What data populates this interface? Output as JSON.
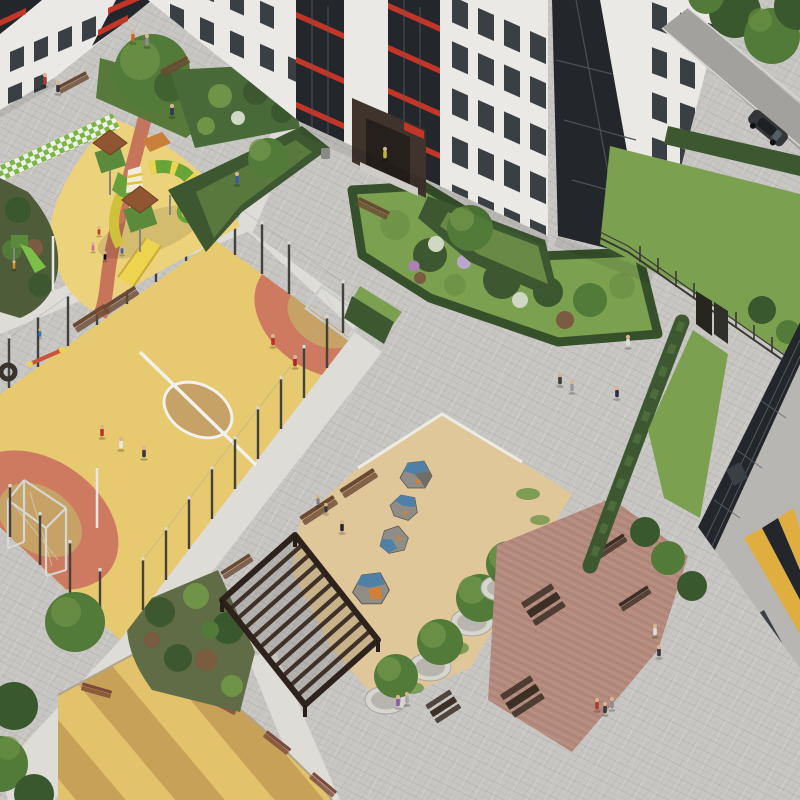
{
  "scene": {
    "title": "Aerial 3D rendering of a residential courtyard",
    "type": "architectural-visualization",
    "view": "isometric aerial view",
    "setting": "apartment complex courtyard with sports field, playgrounds, pergola and landscaping"
  },
  "palette": {
    "plaza": "#c9c7c3",
    "pathLight": "#dedcd6",
    "fieldYellow": "#e7c96f",
    "fieldTan": "#c7a267",
    "playYellow": "#ecd27b",
    "zoneRed": "#cd7a61",
    "sand": "#dfc79a",
    "stripeA": "#e3c26c",
    "stripeB": "#c8a158",
    "facade": "#eae9e6",
    "windowDark": "#3a3f44",
    "glazing": "#23272b",
    "redAccent": "#c23527",
    "roofBrown": "#8f5631",
    "entranceDark": "#3f332c",
    "hedge": "#3d5831",
    "grassLight": "#7ba050",
    "grassDark": "#577a3b",
    "bushLight": "#6f9448",
    "treeDark": "#39582e",
    "treeMid": "#527a38",
    "woodDark": "#3c2f26",
    "benchBrown": "#6b4a33",
    "benchRed": "#7c4a38",
    "planterRim": "#d7d5cf",
    "planterFill": "#b7b5ad",
    "boulderGrey": "#8f8d86",
    "boulderShade": "#6f6d66",
    "boulderBlue": "#4f81a8",
    "accentOrange": "#d08038",
    "road": "#a3a19d",
    "carBody": "#34373a",
    "fenceDark": "#3a3a34",
    "lineWhite": "#f2f1ec",
    "checkerGreen": "#7cb544",
    "slideGreen": "#67a538",
    "slideYellow": "#edd44e",
    "pavRed": "#b48a7d",
    "soil": "#7a5c40",
    "skin": "#d9b48f"
  },
  "objects": {
    "plaza": {
      "label": "paved courtyard plaza"
    },
    "buildingTopLeft": {
      "label": "apartment building, top left"
    },
    "buildingCenter": {
      "label": "apartment building with entrance portal"
    },
    "towerTopRight": {
      "label": "apartment tower with glazed balconies"
    },
    "buildingBottomRight": {
      "label": "apartment building corner with yellow accents"
    },
    "sportsField": {
      "label": "mini football pitch with center circle and goals"
    },
    "playground": {
      "label": "children playground with play structure and slides"
    },
    "climbingArea": {
      "label": "sand play area with climbing boulders"
    },
    "pergola": {
      "label": "wooden slatted pergola"
    },
    "picnicArea": {
      "label": "picnic tables on red pavers"
    },
    "stripedCourt": {
      "label": "striped play surface with benches"
    },
    "garden": {
      "label": "landscaped garden bed with flowering shrubs"
    },
    "lawn": {
      "label": "lawn"
    },
    "road": {
      "label": "access road"
    },
    "car": {
      "label": "car on road"
    },
    "fence": {
      "label": "perimeter fence with gate"
    },
    "people": {
      "label": "residents walking and playing",
      "count": 31
    }
  }
}
